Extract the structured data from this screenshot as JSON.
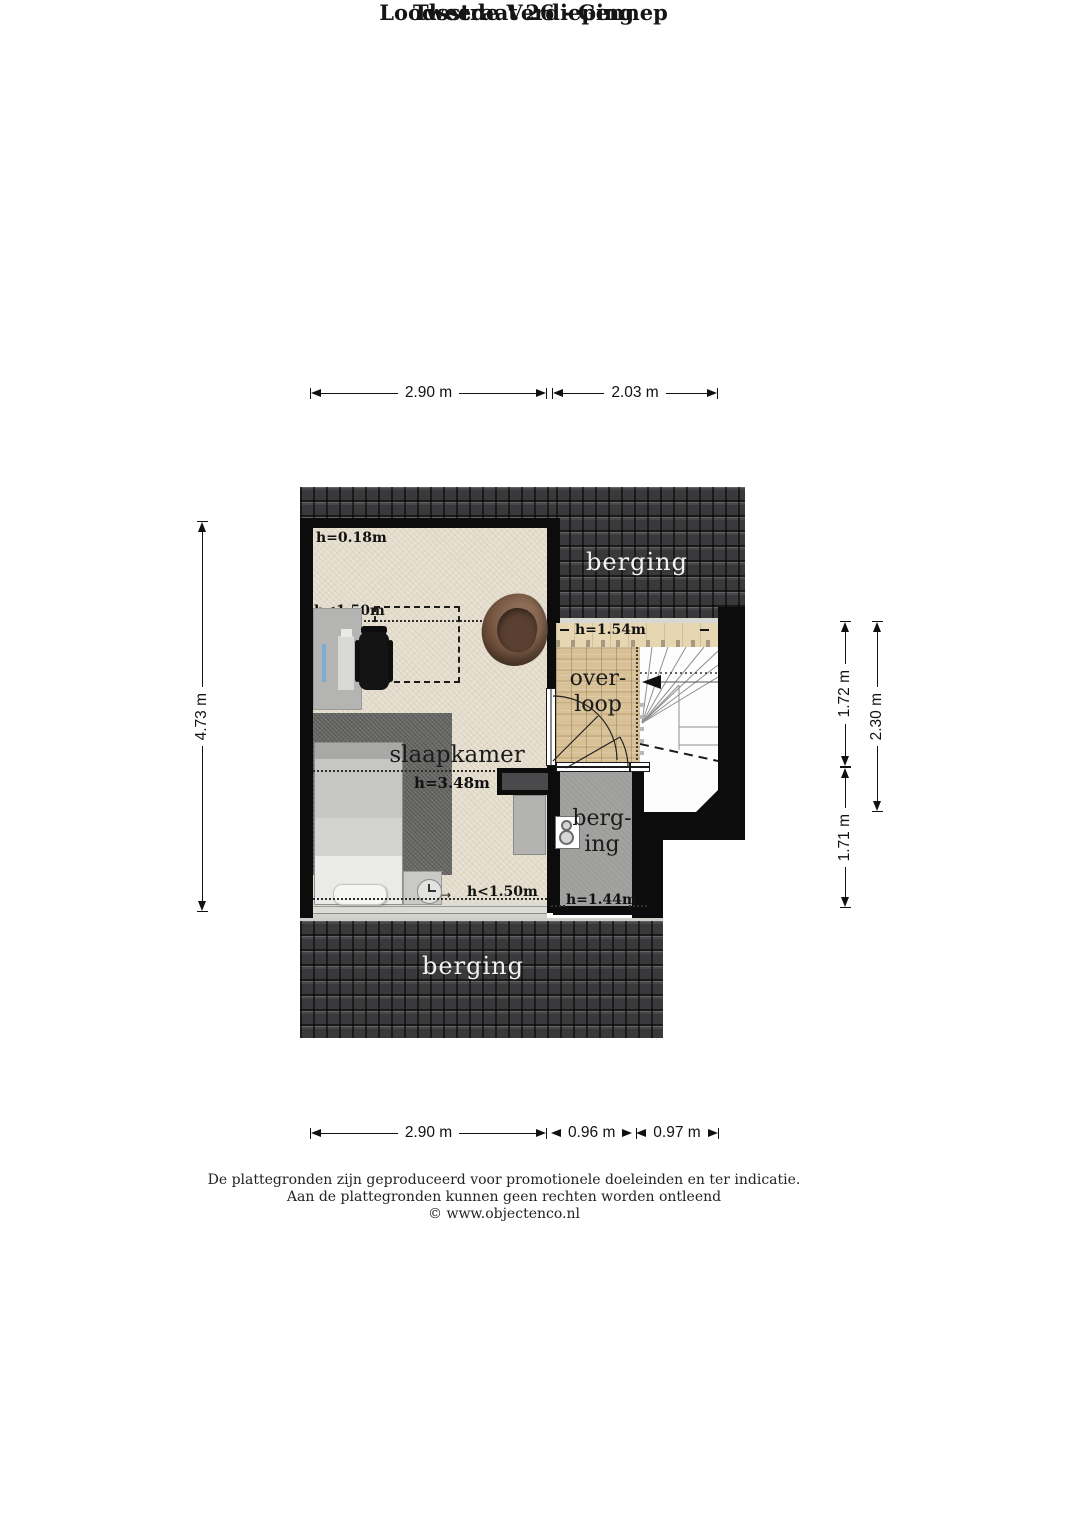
{
  "title": {
    "line1": "Loodsstraat 26 - Gennep",
    "line2": "Tweede Verdieping"
  },
  "dims": {
    "top": [
      "2.90 m",
      "2.03 m"
    ],
    "bottom": [
      "2.90 m",
      "0.96 m",
      "0.97 m"
    ],
    "left": [
      "4.73 m"
    ],
    "right": [
      "1.72 m",
      "1.71 m",
      "2.30 m"
    ]
  },
  "rooms": {
    "slaapkamer": {
      "name": "slaapkamer",
      "height": "h=3.48m"
    },
    "overloop": {
      "name_line1": "over-",
      "name_line2": "loop",
      "height": "h=1.54m"
    },
    "berging_klein": {
      "name_line1": "berg-",
      "name_line2": "ing",
      "height": "h=1.44m"
    },
    "berging_boven": {
      "name": "berging"
    },
    "berging_onder": {
      "name": "berging"
    }
  },
  "annotations": {
    "h_top_left": "h=0.18m",
    "h_dormer": "h<1.50m",
    "h_bottom": "h<1.50m",
    "arrow_right": "→"
  },
  "footer": {
    "line1": "De plattegronden zijn geproduceerd voor promotionele doeleinden en ter indicatie.",
    "line2": "Aan de plattegronden kunnen geen rechten worden ontleend",
    "line3": "© www.objectenco.nl"
  },
  "icons": {
    "clock": "clock-icon",
    "boiler": "boiler-icon",
    "stairs_arrow": "stairs-direction-arrow"
  },
  "colors": {
    "roof": "#39393b",
    "wall": "#0c0c0c",
    "carpet": "#e8e1d2",
    "wood": "#d8c196",
    "wood_light": "#e6d6b2",
    "floor_gray": "#a2a2a0",
    "rug": "#6c6c6a",
    "armchair": "#6d4f3b",
    "page": "#ffffff"
  }
}
